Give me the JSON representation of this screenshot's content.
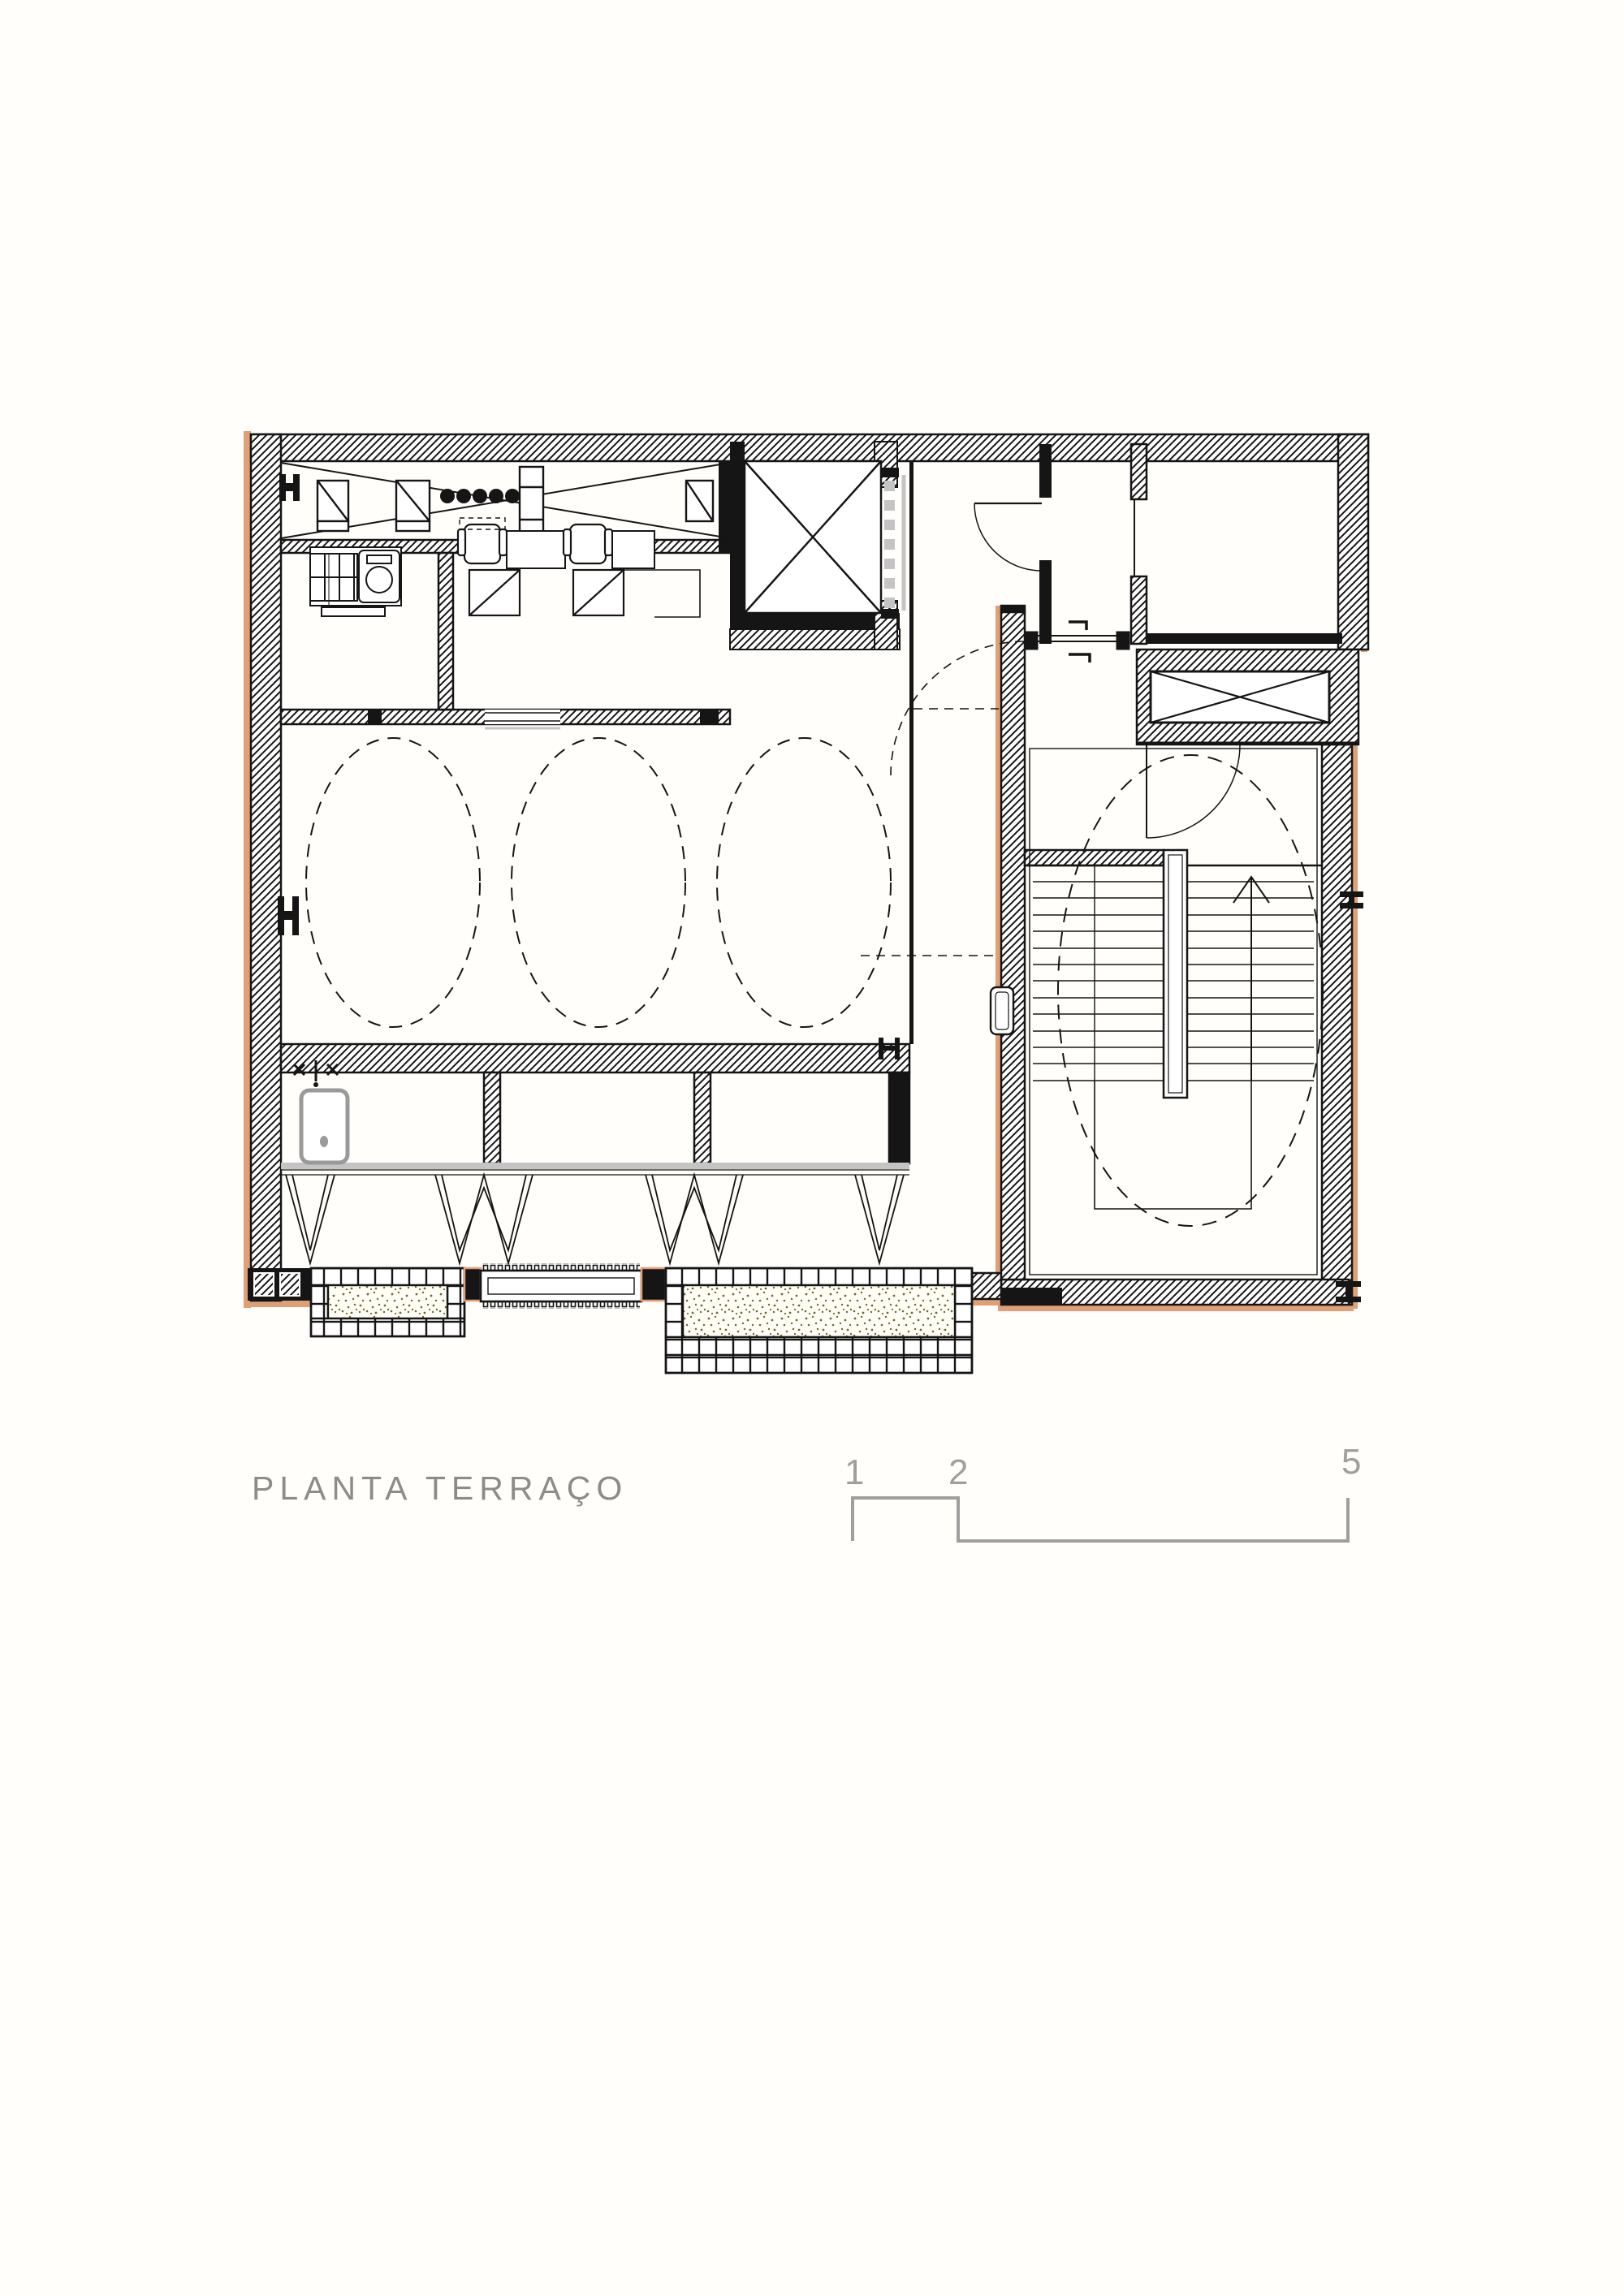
{
  "page": {
    "background": "#fffefa",
    "width": "2000",
    "height": "2828"
  },
  "drawing": {
    "title": "PLANTA TERRAÇO",
    "kind": "architectural floor plan, terrace level",
    "symbols": [
      "hatched-wall",
      "steel-column",
      "elevator-x-shaft",
      "duct-x-shaft",
      "door-swing",
      "dashed-ceiling-circle",
      "sink",
      "faucet-valves",
      "stair-treads",
      "stair-direction-arrow",
      "planter-tiles",
      "gravel-speckle",
      "floor-grille",
      "workstation-chair",
      "equipment-unit",
      "louver-zigzag"
    ]
  },
  "scale_bar": {
    "labels": [
      "1",
      "2",
      "5"
    ]
  },
  "colors": {
    "ink": "#151515",
    "tan": "#dfa077",
    "gray_fixture": "#9a9a9a",
    "light_gray": "#c4c4c4",
    "speckle": "#6c6c30",
    "text_gray": "#8c8c8c",
    "scale_gray": "#9f9f9f",
    "page_bg": "#fffefa"
  }
}
